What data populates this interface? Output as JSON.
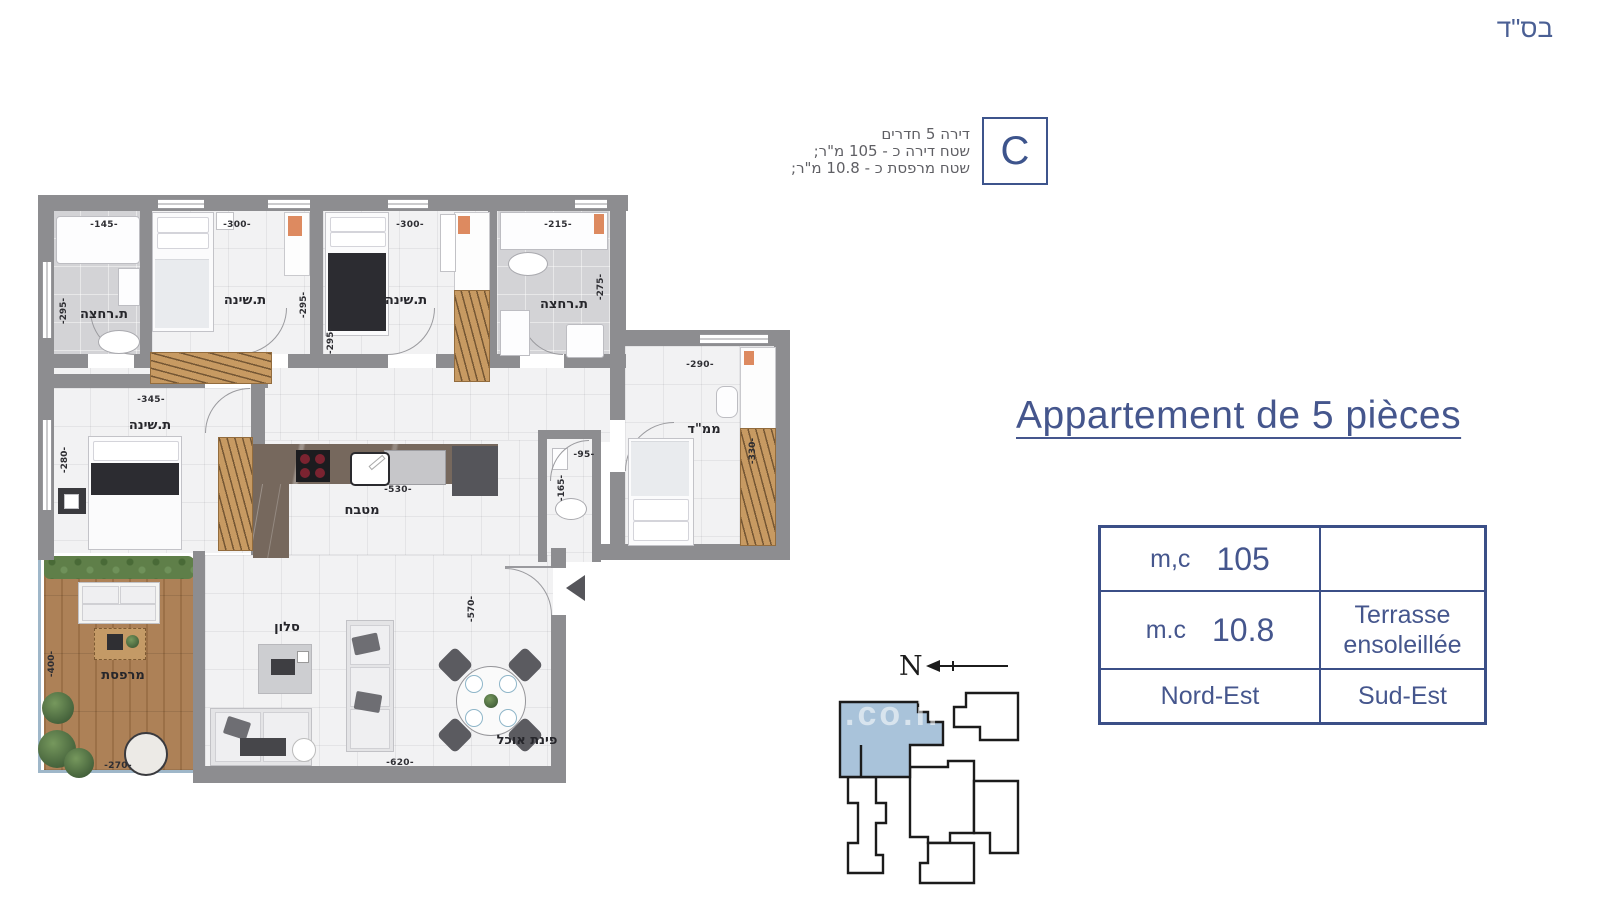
{
  "page": {
    "bsd": "בס\"ד",
    "watermark": ".co.il"
  },
  "unit_badge": {
    "letter": "C",
    "line1": "דירה 5 חדרים",
    "line2": "שטח דירה כ - 105 מ\"ר;",
    "line3": "שטח מרפסת כ - 10.8 מ\"ר;"
  },
  "title": {
    "text": "Appartement de 5 pièces"
  },
  "spec_table": {
    "area_label": "m,c",
    "area_value": "105",
    "terrace_label": "m.c",
    "terrace_value": "10.8",
    "terrace_desc_line1": "Terrasse",
    "terrace_desc_line2": "ensoleillée",
    "orientation_left": "Nord-Est",
    "orientation_right": "Sud-Est"
  },
  "compass": {
    "north": "N"
  },
  "rooms": {
    "bath1": {
      "label": "ת.רחצה",
      "dim_top": "-145-",
      "dim_side": "-295-"
    },
    "bed1": {
      "label": "ת.שינה",
      "dim_top": "-300-",
      "dim_side": "-295-"
    },
    "bed2": {
      "label": "ת.שינה",
      "dim_top": "-300-",
      "dim_side": "-295-"
    },
    "bath2": {
      "label": "ת.רחצה",
      "dim_top": "-215-",
      "dim_side": "-275-"
    },
    "mamad": {
      "label": "ממ\"ד",
      "dim_top": "-290-",
      "dim_side": "-330-"
    },
    "bed3": {
      "label": "ת.שינה",
      "dim_top": "-345-",
      "dim_side": "-280-"
    },
    "kitchen": {
      "label": "מטבח",
      "dim": "-530-"
    },
    "wc": {
      "dim_top": "-95-",
      "dim_side": "-165-"
    },
    "living": {
      "label": "סלון",
      "dim_bottom": "-620-",
      "dim_side": "-570-"
    },
    "dining": {
      "label": "פינת אוכל"
    },
    "terrace": {
      "label": "מרפסת",
      "dim_side": "-400-",
      "dim_bottom": "-270-"
    }
  },
  "colors": {
    "accent": "#45568d",
    "wall": "#8d8d90",
    "keyplan_highlight": "#a9c3da",
    "wardrobe_wood": "#c79a62",
    "deck_wood": "#ab7e52"
  }
}
